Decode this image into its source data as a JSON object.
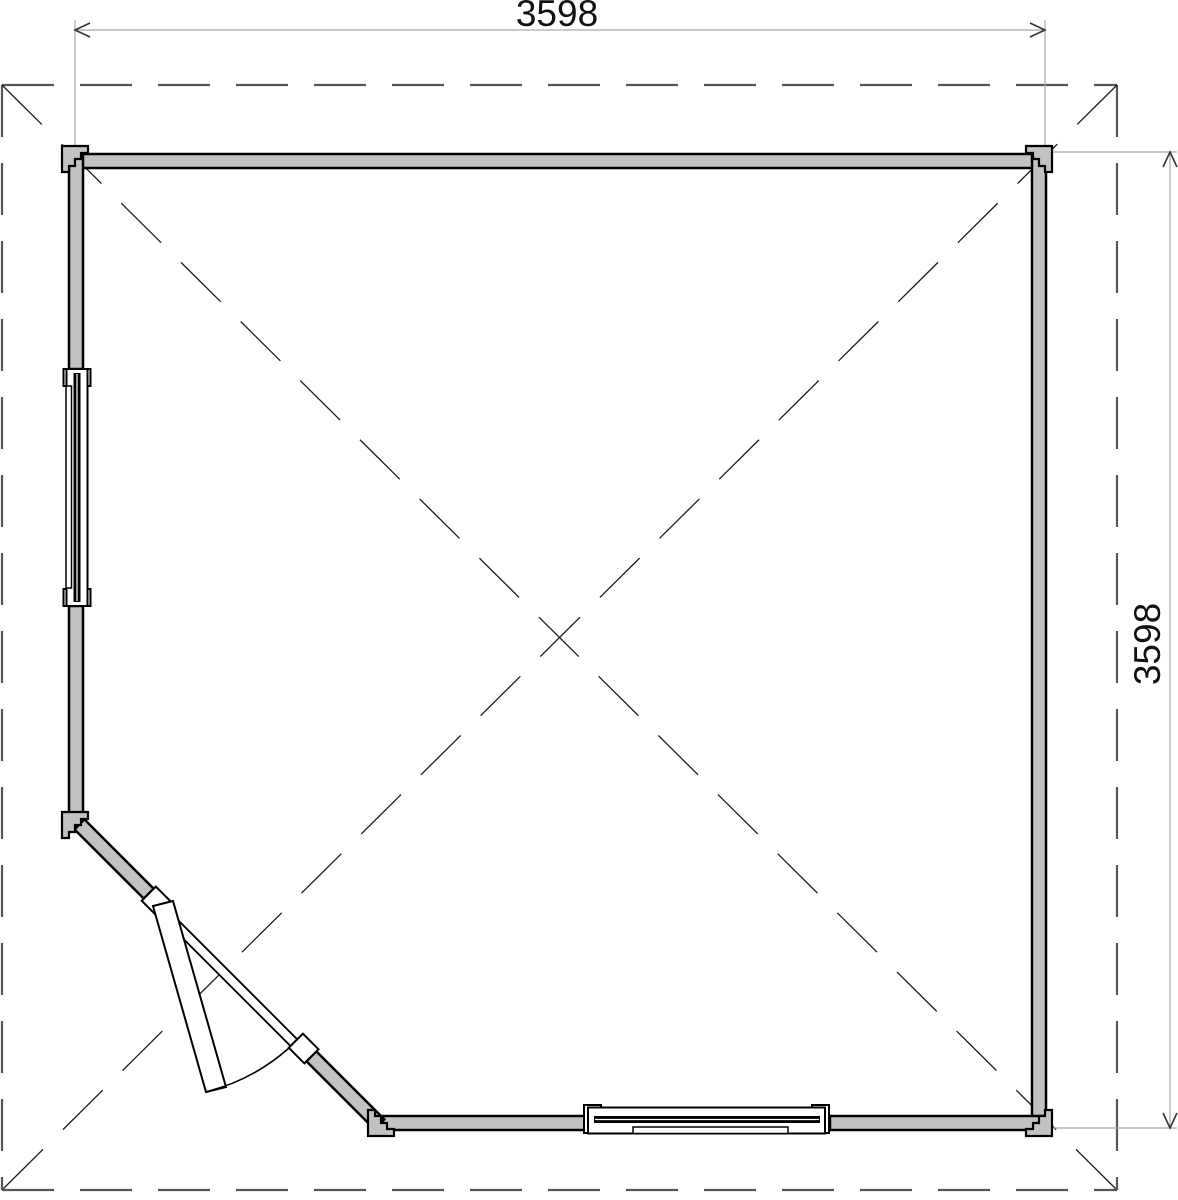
{
  "drawing": {
    "dimensions": {
      "width_label": "3598",
      "height_label": "3598"
    },
    "colors": {
      "wall_fill": "#c2c2c2",
      "outline": "#000000",
      "dimension_line": "#a8a8a8",
      "arrow": "#333333",
      "roof_dash": "#565656",
      "diagonal_dash": "#1c1c1c",
      "background": "#ffffff"
    }
  }
}
